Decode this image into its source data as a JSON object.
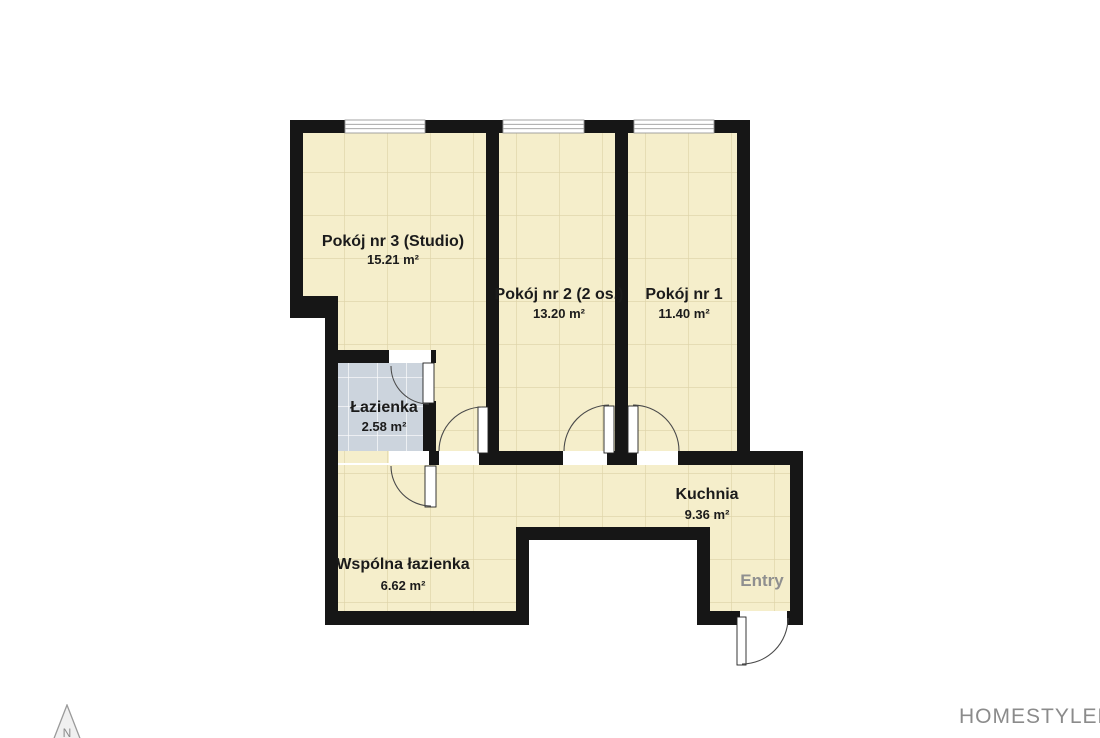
{
  "branding": {
    "logo_text": "HOMESTYLER",
    "blade_colors": [
      "#3f7dbd",
      "#bf4e42",
      "#5ea24e",
      "#e9ae3c"
    ]
  },
  "compass": {
    "label": "N"
  },
  "plan": {
    "colors": {
      "wall": "#161616",
      "floor": "#f5eecb",
      "floor_grid": "#dcd2a6",
      "bath": "#ccd4dd",
      "bath_grid": "#ffffff",
      "dim_line": "#4a4a4a",
      "dim_text": "#2d2d2d",
      "room_text": "#1b1b1b",
      "muted_text": "#8f8f8f",
      "door": "#4a4a4a",
      "window_frame": "#9a9a9a"
    },
    "floors": [
      {
        "t": "cream",
        "r": [
          303,
          133,
          183,
          170
        ]
      },
      {
        "t": "cream",
        "r": [
          338,
          296,
          148,
          167
        ]
      },
      {
        "t": "cream",
        "r": [
          499,
          133,
          116,
          330
        ]
      },
      {
        "t": "cream",
        "r": [
          628,
          133,
          109,
          330
        ]
      },
      {
        "t": "cream",
        "r": [
          436,
          465,
          354,
          62
        ]
      },
      {
        "t": "cream",
        "r": [
          710,
          527,
          80,
          84
        ]
      },
      {
        "t": "cream",
        "r": [
          338,
          465,
          178,
          150
        ]
      },
      {
        "t": "gray",
        "r": [
          338,
          363,
          85,
          88
        ]
      }
    ],
    "walls": [
      [
        290,
        120,
        460,
        13
      ],
      [
        290,
        120,
        13,
        198
      ],
      [
        290,
        296,
        48,
        22
      ],
      [
        325,
        296,
        13,
        329
      ],
      [
        325,
        350,
        111,
        13
      ],
      [
        423,
        401,
        13,
        64
      ],
      [
        486,
        133,
        13,
        332
      ],
      [
        615,
        133,
        13,
        332
      ],
      [
        436,
        451,
        367,
        14
      ],
      [
        737,
        120,
        13,
        345
      ],
      [
        790,
        451,
        13,
        174
      ],
      [
        697,
        611,
        106,
        14
      ],
      [
        697,
        527,
        13,
        98
      ],
      [
        516,
        527,
        194,
        13
      ],
      [
        516,
        527,
        13,
        98
      ],
      [
        325,
        611,
        204,
        14
      ]
    ],
    "openings": [
      [
        389,
        350,
        42,
        13
      ],
      [
        439,
        451,
        40,
        14
      ],
      [
        563,
        451,
        44,
        14
      ],
      [
        637,
        451,
        41,
        14
      ],
      [
        389,
        451,
        40,
        14
      ],
      [
        740,
        611,
        47,
        14
      ]
    ],
    "windows": [
      [
        345,
        120,
        80,
        13
      ],
      [
        503,
        120,
        81,
        13
      ],
      [
        634,
        120,
        80,
        13
      ]
    ],
    "leaves": [
      [
        423,
        363,
        11,
        40
      ],
      [
        478,
        407,
        10,
        46
      ],
      [
        604,
        406,
        10,
        47
      ],
      [
        628,
        406,
        10,
        47
      ],
      [
        425,
        466,
        11,
        41
      ],
      [
        737,
        617,
        9,
        48
      ]
    ],
    "arcs": [
      "M391 366 A38 38 0 0 0 429 404",
      "M439 451 A44 44 0 0 1 482 407",
      "M564 451 A46 46 0 0 1 609 405",
      "M633 405 A46 46 0 0 1 679 451",
      "M391 466 A40 40 0 0 0 431 506",
      "M742 664 A46 46 0 0 0 788 618"
    ],
    "rooms": [
      {
        "name": "Pokój nr 3 (Studio)",
        "area": "15.21 m²",
        "x": 393,
        "y": 246,
        "ay": 264
      },
      {
        "name": "Pokój nr 2 (2 os.)",
        "area": "13.20 m²",
        "x": 559,
        "y": 299,
        "ay": 318
      },
      {
        "name": "Pokój nr 1",
        "area": "11.40 m²",
        "x": 684,
        "y": 299,
        "ay": 318
      },
      {
        "name": "Łazienka",
        "area": "2.58 m²",
        "x": 384,
        "y": 412,
        "ay": 431
      },
      {
        "name": "Kuchnia",
        "area": "9.36 m²",
        "x": 707,
        "y": 499,
        "ay": 519
      },
      {
        "name": "Wspólna łazienka",
        "area": "6.62 m²",
        "x": 403,
        "y": 569,
        "ay": 590
      },
      {
        "name": "Entry",
        "area": "",
        "x": 762,
        "y": 586,
        "muted": true
      }
    ],
    "dims": [
      {
        "o": "h",
        "pos": 48,
        "a": 300,
        "b": 800,
        "ticks": [
          300,
          800
        ],
        "labels": [
          {
            "t": "9610mm",
            "at": 550
          }
        ]
      },
      {
        "o": "h",
        "pos": 64,
        "a": 300,
        "b": 800,
        "ticks": [
          300,
          495,
          622,
          734,
          800
        ],
        "labels": [
          {
            "t": "3690mm",
            "at": 398
          },
          {
            "t": "2440mm",
            "at": 558
          },
          {
            "t": "2140mm",
            "at": 678
          },
          {
            "t": "1100mm",
            "at": 767
          }
        ]
      },
      {
        "o": "v",
        "pos": 222,
        "a": 119,
        "b": 612,
        "lx": 217,
        "ticks": [
          119,
          612
        ],
        "labels": [
          {
            "t": "9460mm",
            "at": 365
          }
        ]
      },
      {
        "o": "v",
        "pos": 238,
        "a": 119,
        "b": 608,
        "lx": 234,
        "ticks": [
          119,
          297,
          346,
          440,
          608
        ],
        "labels": [
          {
            "t": "3400mm",
            "at": 208
          },
          {
            "t": "900mm",
            "at": 321
          },
          {
            "t": "1940mm",
            "at": 393
          },
          {
            "t": "2980mm",
            "at": 524
          }
        ]
      },
      {
        "o": "v",
        "pos": 860,
        "a": 119,
        "b": 597,
        "lx": 855,
        "ticks": [
          119,
          445,
          597
        ],
        "labels": [
          {
            "t": "6240mm",
            "at": 282
          },
          {
            "t": "2840mm",
            "at": 521
          }
        ]
      },
      {
        "o": "v",
        "pos": 877,
        "a": 119,
        "b": 612,
        "lx": 889,
        "ticks": [
          119,
          612
        ],
        "labels": [
          {
            "t": "9460mm",
            "at": 365
          }
        ]
      },
      {
        "o": "h",
        "pos": 676,
        "a": 300,
        "b": 791,
        "ticks": [
          300,
          341,
          519,
          691,
          791
        ],
        "labels": [
          {
            "t": "730mm",
            "at": 320
          },
          {
            "t": "3400mm",
            "at": 430
          },
          {
            "t": "3300mm",
            "at": 605
          },
          {
            "t": "1940mm",
            "at": 741
          }
        ]
      },
      {
        "o": "h",
        "pos": 697,
        "a": 300,
        "b": 800,
        "ticks": [
          300,
          800
        ],
        "labels": [
          {
            "t": "9610mm",
            "at": 550
          }
        ]
      }
    ]
  }
}
